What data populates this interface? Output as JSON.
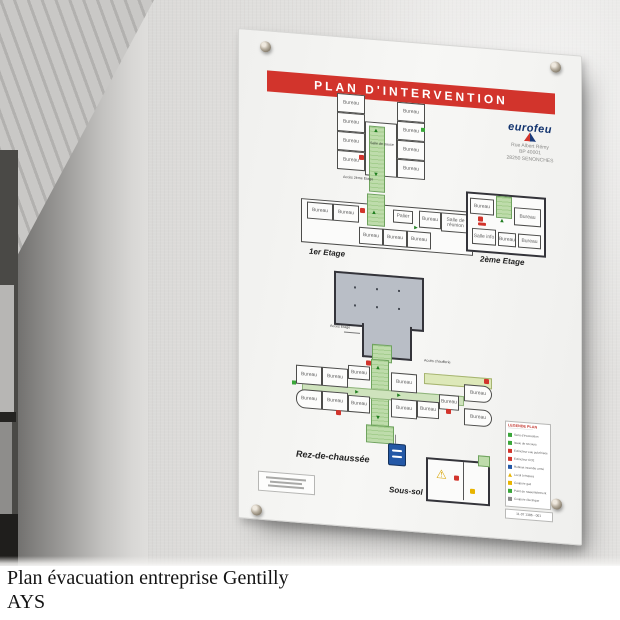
{
  "caption": {
    "line1": "Plan évacuation entreprise Gentilly",
    "line2": "AYS"
  },
  "poster": {
    "title": "PLAN D'INTERVENTION",
    "logo": {
      "brand": "eurofeu",
      "address_lines": [
        "Rue Albert Rémy",
        "BP 40001",
        "28250 SENONCHES"
      ]
    },
    "floor_labels": {
      "first": "1er Etage",
      "second": "2ème Etage",
      "ground": "Rez-de-chaussée",
      "basement": "Sous-sol"
    },
    "access_labels": {
      "second_floor": "Accès 2ème Etage",
      "floor": "Accès Etage",
      "boiler": "Accès chaufferie"
    },
    "rooms": {
      "office": "Bureau",
      "meeting": "Salle de réunion",
      "break": "Salle de pause",
      "info": "Salle info",
      "landing": "Palier"
    },
    "legend": {
      "title": "LEGENDE PLAN",
      "items": [
        {
          "color": "green",
          "label": "Sens d'évacuation"
        },
        {
          "color": "green",
          "label": "Issue de secours"
        },
        {
          "color": "red",
          "label": "Extincteur eau pulvérisée"
        },
        {
          "color": "red",
          "label": "Extincteur CO2"
        },
        {
          "color": "blue",
          "label": "Robinet incendie armé"
        },
        {
          "color": "yellow",
          "label": "Local à risques"
        },
        {
          "color": "yellow",
          "label": "Coupure gaz"
        },
        {
          "color": "green",
          "label": "Point de rassemblement"
        },
        {
          "color": "gray",
          "label": "Coupure électrique"
        }
      ],
      "ref": "11-07 1386 - 001"
    },
    "colors": {
      "banner_red": "#d2342c",
      "corridor_green": "#bedcab",
      "hall_gray": "#b9bec6",
      "logo_blue": "#12336e",
      "marker_blue": "#2458a6",
      "warning_yellow": "#e8b400"
    }
  }
}
